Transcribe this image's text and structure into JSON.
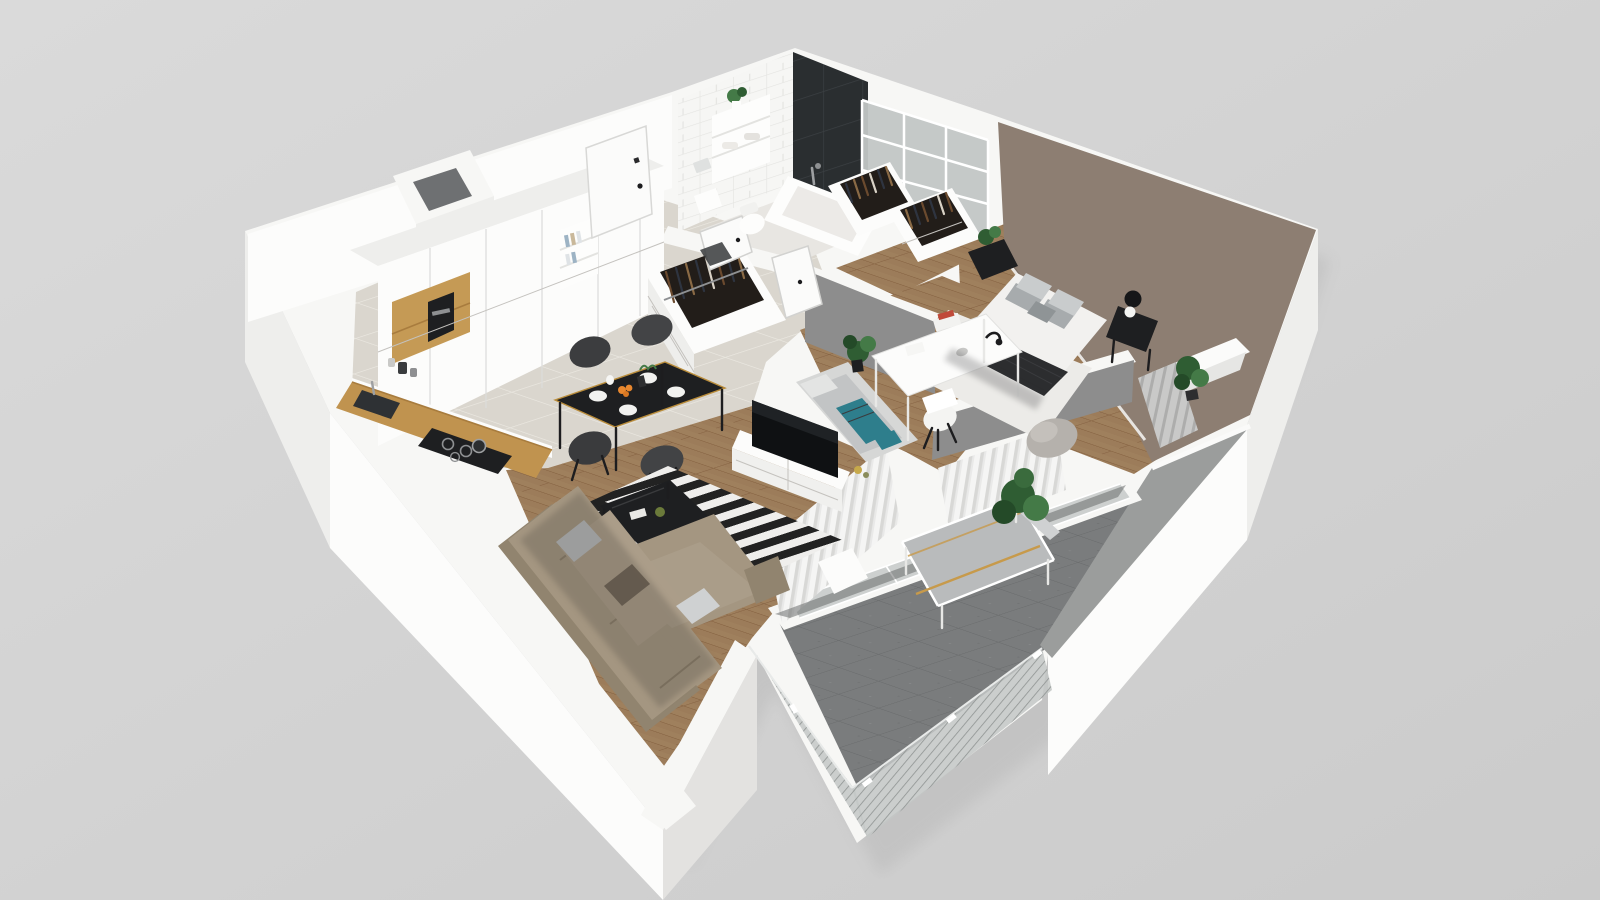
{
  "scene": {
    "name": "apartment-3d-floorplan-render",
    "description": "Isometric cutaway 3D render of a furnished two-room apartment with balcony on a plain gray backdrop",
    "rooms": [
      {
        "name": "kitchen",
        "floor": "light-tile",
        "furniture": [
          "white-tall-cabinets",
          "wood-niche-with-coffee-machine",
          "wood-countertop",
          "induction-hob",
          "sink-with-faucet"
        ]
      },
      {
        "name": "hallway",
        "floor": "light-tile",
        "furniture": [
          "entrance-door",
          "white-wardrobe",
          "bookshelf-niche",
          "open-wardrobe-with-clothes"
        ]
      },
      {
        "name": "bathroom",
        "floor": "light-tile",
        "furniture": [
          "bathtub",
          "toilet",
          "shelves-with-towels",
          "black-tile-shower-wall",
          "plant"
        ]
      },
      {
        "name": "walk-in-closet",
        "floor": "wood",
        "furniture": [
          "two-open-closets-with-clothes",
          "glass-grid-partition"
        ]
      },
      {
        "name": "bedroom",
        "wall": "taupe",
        "floor": "wood-with-white-rug",
        "furniture": [
          "double-bed",
          "gray-pillows",
          "dark-throw",
          "nightstand-with-plant",
          "nightstand-with-lamp",
          "armchair",
          "plant",
          "window-with-curtains"
        ]
      },
      {
        "name": "office",
        "wall": "gray",
        "floor": "wood",
        "furniture": [
          "white-desk",
          "desk-lamp",
          "white-shell-chair",
          "daybed-with-teal-bedding",
          "plant"
        ]
      },
      {
        "name": "living-room",
        "floor": "wood",
        "furniture": [
          "corner-sofa-taupe",
          "striped-rug-black-white",
          "black-coffee-table",
          "white-tv-unit",
          "tv",
          "dining-table-black",
          "four-dark-chairs",
          "table-setting-with-fruit"
        ]
      },
      {
        "name": "balcony",
        "floor": "dark-gray-tile",
        "furniture": [
          "outdoor-bench-gray-cushion",
          "large-plant",
          "glass-balustrade"
        ]
      }
    ]
  },
  "palette": {
    "bg1": "#d9d9d9",
    "bg2": "#cccccc",
    "shadow": "#b6b6b6",
    "wallWhite": "#f7f7f5",
    "wallBright": "#fcfcfb",
    "wallShade": "#eeeeec",
    "wallShade2": "#e3e2e0",
    "grayWall": "#8d8d8d",
    "grayWall2": "#9b9d9c",
    "taupe": "#8d7e72",
    "tileBase": "#dad6ce",
    "woodBase": "#9c7c5a",
    "balconyTile": "#7a7c7d",
    "rugBlack": "#222222",
    "rugWhite": "#efeeec",
    "sofa": "#a49681",
    "sofaDark": "#91846f",
    "cushionGray": "#b9bcbe",
    "teal": "#2e7e8c",
    "black": "#1e1f21",
    "counterWood": "#c0934f",
    "glass": "#c2c6c5",
    "plantGreen": "#2f5d33",
    "plantGreen2": "#447a47",
    "doorWhite": "#fbfbfa",
    "bedWhite": "#f2f1ef",
    "throwDark": "#2c2d2f",
    "pillowGray": "#a7abad",
    "bedRug": "#ecebe8",
    "benchGray": "#b9bbbc",
    "blackTileWall": "#2a2e30",
    "bathFloor": "#e8e6e2",
    "orange": "#e8872e",
    "red": "#c04a3a",
    "woodNiche": "#c59a55"
  }
}
